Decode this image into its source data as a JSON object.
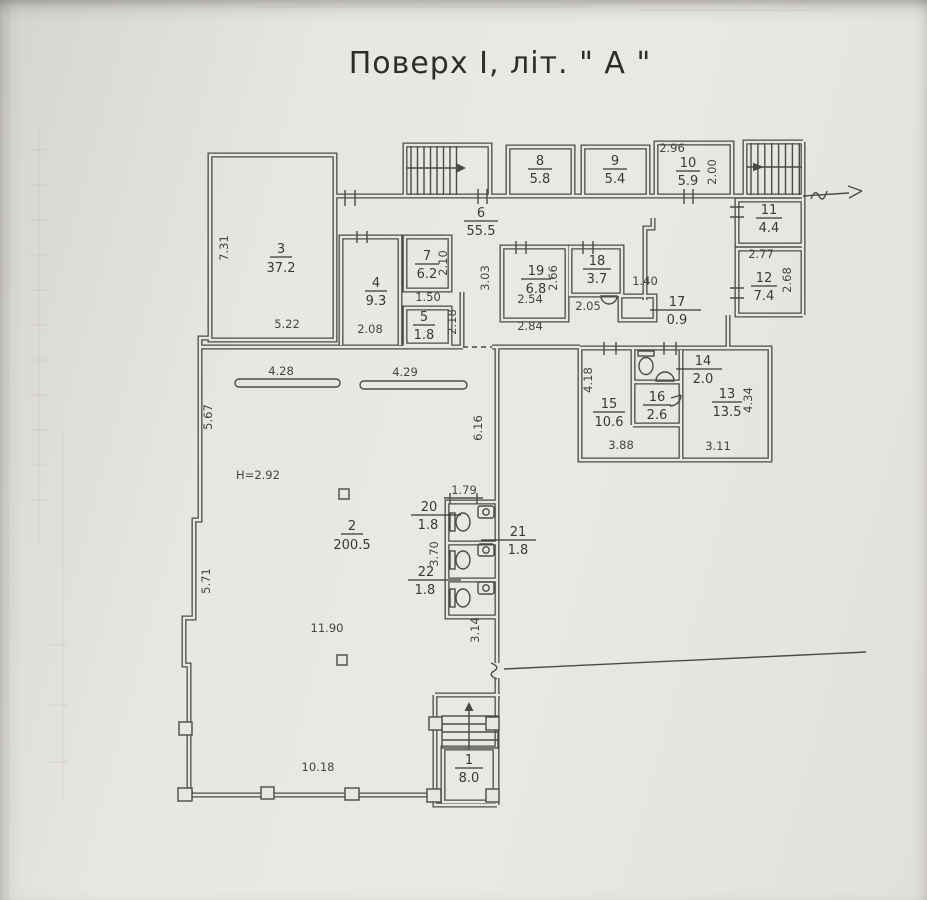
{
  "title": "Поверх І, літ. \" А \"",
  "colors": {
    "ink": "#4c4a45",
    "paper": "#e9e7e2"
  },
  "rooms": {
    "r1": {
      "num": "1",
      "area": "8.0"
    },
    "r2": {
      "num": "2",
      "area": "200.5"
    },
    "r3": {
      "num": "3",
      "area": "37.2"
    },
    "r4": {
      "num": "4",
      "area": "9.3"
    },
    "r5": {
      "num": "5",
      "area": "1.8"
    },
    "r6": {
      "num": "6",
      "area": "55.5"
    },
    "r7": {
      "num": "7",
      "area": "6.2"
    },
    "r8": {
      "num": "8",
      "area": "5.8"
    },
    "r9": {
      "num": "9",
      "area": "5.4"
    },
    "r10": {
      "num": "10",
      "area": "5.9"
    },
    "r11": {
      "num": "11",
      "area": "4.4"
    },
    "r12": {
      "num": "12",
      "area": "7.4"
    },
    "r13": {
      "num": "13",
      "area": "13.5"
    },
    "r14": {
      "num": "14",
      "area": "2.0"
    },
    "r15": {
      "num": "15",
      "area": "10.6"
    },
    "r16": {
      "num": "16",
      "area": "2.6"
    },
    "r17": {
      "num": "17",
      "area": "0.9"
    },
    "r18": {
      "num": "18",
      "area": "3.7"
    },
    "r19": {
      "num": "19",
      "area": "6.8"
    },
    "r20": {
      "num": "20",
      "area": "1.8"
    },
    "r21": {
      "num": "21",
      "area": "1.8"
    },
    "r22": {
      "num": "22",
      "area": "1.8"
    }
  },
  "dims": {
    "room3_h": "7.31",
    "room3_w": "5.22",
    "room4_w": "2.08",
    "room4_pass": "1.50",
    "room7_h": "2.10",
    "niche_h": "2.18",
    "room19_hl": "3.03",
    "room19_hr": "2.66",
    "room19_w_in": "2.54",
    "room19_w_out": "2.84",
    "room18_w": "2.05",
    "room18_gap": "1.40",
    "room10_w": "2.96",
    "room10_h": "2.00",
    "room12_w": "2.77",
    "room12_h": "2.68",
    "room15_h": "4.18",
    "room15_w": "3.88",
    "room13_w": "3.11",
    "room13_h": "4.34",
    "counter_left": "4.28",
    "counter_right": "4.29",
    "hall_left_upper": "5.67",
    "hall_left_lower": "5.71",
    "hall_right": "6.16",
    "ceiling_height": "H=2.92",
    "stall_w": "1.79",
    "stalls_h": "3.70",
    "hall_w": "11.90",
    "wing_h": "3.14",
    "hall_bottom_w": "10.18"
  }
}
